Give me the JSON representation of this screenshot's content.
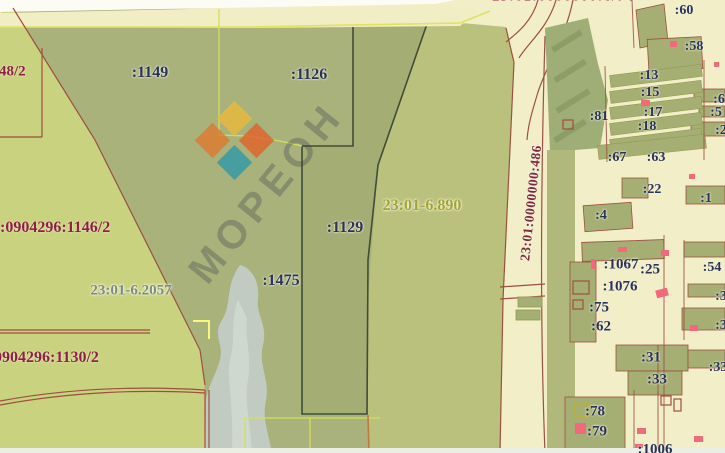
{
  "app": {
    "description": "Public cadastral map viewport with land parcels, zone boundaries and watermark"
  },
  "watermark": {
    "brand": "МОРЕОН"
  },
  "palette": {
    "parcel_olive": "#a9b27b",
    "parcel_east": "#b9c17c",
    "parcel_selected": "#a4ad74",
    "parcel_bright": "#c9d27e",
    "road_fill": "#f1edc4",
    "water": "#c1cbc2",
    "boundary_maroon": "#9c5040",
    "boundary_yellowgreen": "#d5de5b",
    "label_navy": "#293257",
    "label_maroon": "#8e2044",
    "zone_label_olive": "#a3a433",
    "building_marker_red": "#f16a7c",
    "selected_outline": "#414d38",
    "logo_yellow": "#e8b93a",
    "logo_orange": "#e2622c",
    "logo_red_orange": "#dd7a30",
    "logo_teal": "#2f9aa8"
  },
  "labels": {
    "p1149": ":1149",
    "p1126": ":1126",
    "p1129": ":1129",
    "p1475": ":1475",
    "p48": ":48/2",
    "p60": ":60",
    "p58": ":58",
    "p13": ":13",
    "p15": ":15",
    "p17": ":17",
    "p18": ":18",
    "p81": ":81",
    "p67": ":67",
    "p63": ":63",
    "p22": ":22",
    "p4": ":4",
    "p1067": ":1067",
    "p25": ":25",
    "p1076": ":1076",
    "p75": ":75",
    "p62": ":62",
    "p31": ":31",
    "p33": ":33",
    "p78": ":78",
    "p79": ":79",
    "p1006": ":1006",
    "p54": ":54",
    "p6": ":6",
    "p5": ":5",
    "p2": ":2",
    "p1": ":1",
    "p3a": ":3",
    "p3b": ":3",
    "p33b": ":33",
    "left_upper": "1:0904296:1146/2",
    "left_lower": "0904296:1130/2",
    "zone_a": "23:01-6.890",
    "zone_b": "23:01-6.2057",
    "road_parcel": "23:01:0000000:486",
    "top_clipped": "23:01:0000000:6/74"
  }
}
